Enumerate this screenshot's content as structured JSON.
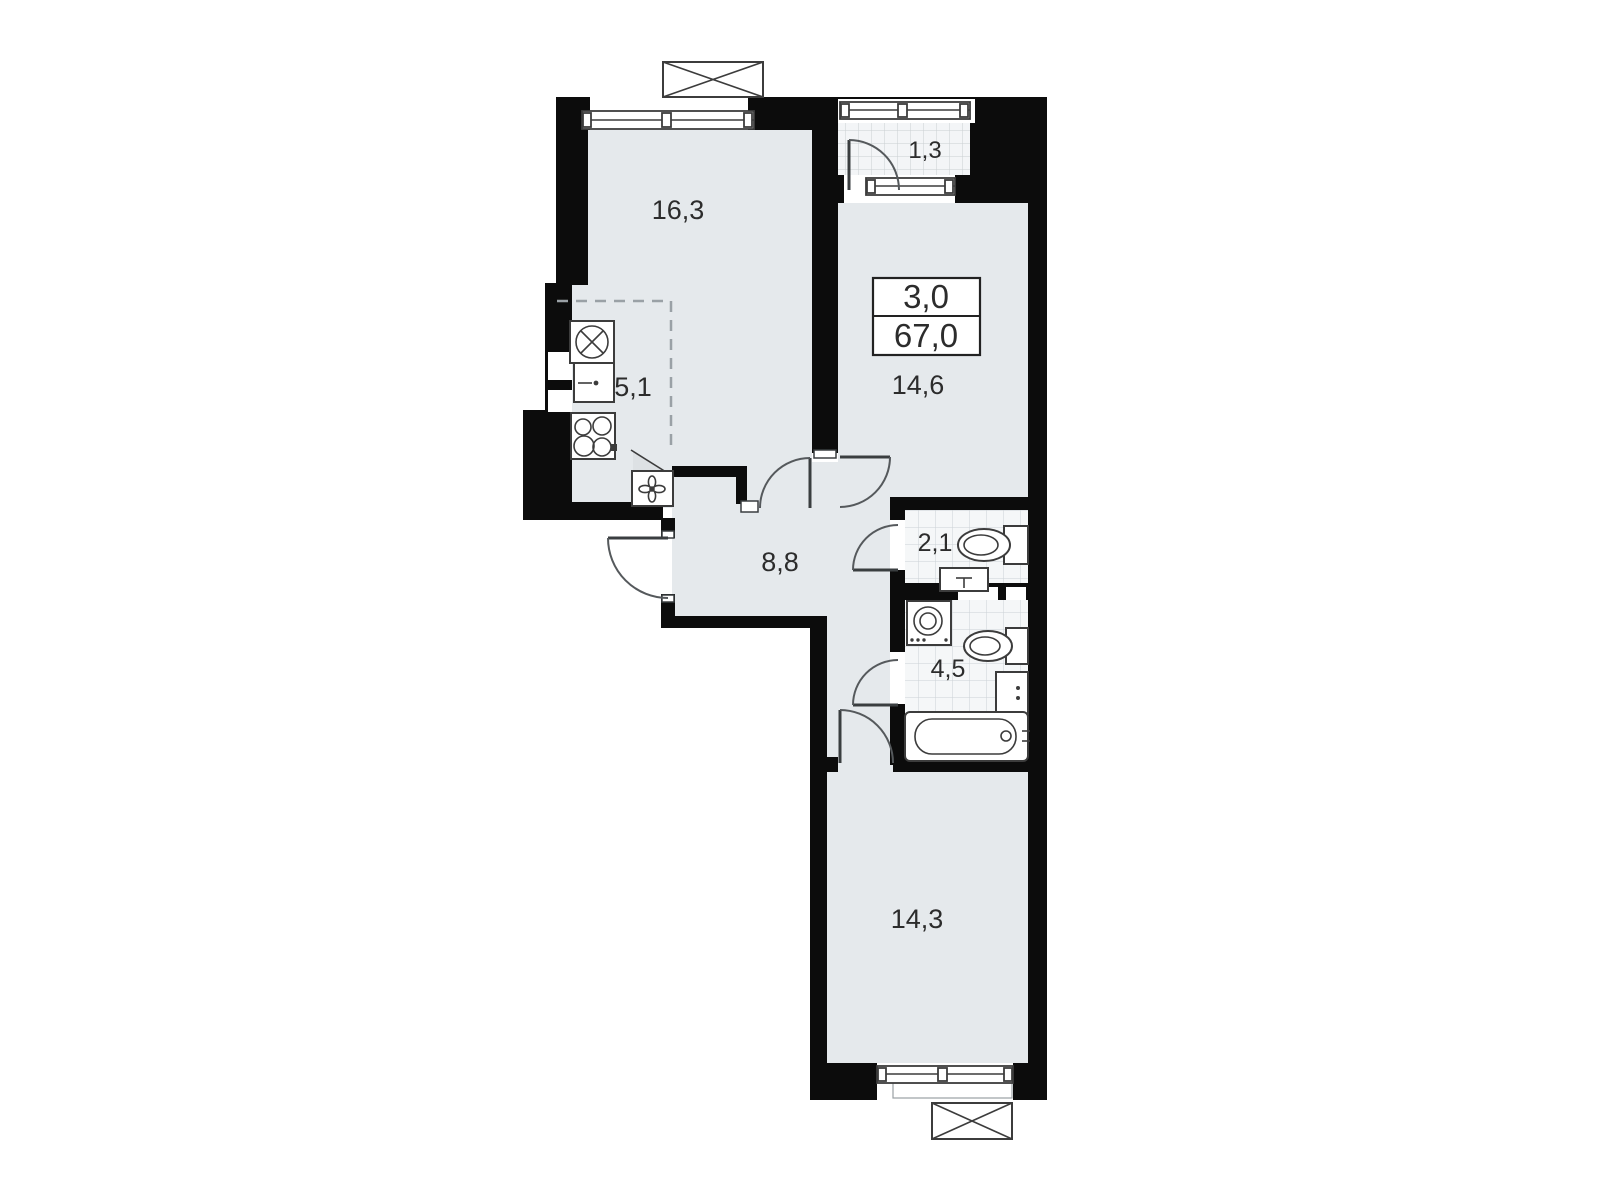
{
  "plan": {
    "title": "3-room apartment floor plan",
    "info_box": {
      "rooms_count": "3,0",
      "total_area": "67,0"
    },
    "rooms": [
      {
        "name": "living-room",
        "area": "16,3"
      },
      {
        "name": "kitchen",
        "area": "5,1"
      },
      {
        "name": "bedroom-1",
        "area": "14,6"
      },
      {
        "name": "balcony",
        "area": "1,3"
      },
      {
        "name": "hallway",
        "area": "8,8"
      },
      {
        "name": "wc",
        "area": "2,1"
      },
      {
        "name": "bathroom",
        "area": "4,5"
      },
      {
        "name": "bedroom-2",
        "area": "14,3"
      }
    ],
    "icons": [
      "kitchen-sink-icon",
      "refrigerator-icon",
      "stove-icon",
      "extractor-fan-icon",
      "toilet-icon",
      "wash-basin-icon",
      "washing-machine-icon",
      "bathtub-icon",
      "window-icon",
      "air-conditioner-icon",
      "door-swing-icon",
      "duct-shaft-icon"
    ],
    "colors": {
      "wall": "#0c0c0c",
      "floor": "#e5e9ec",
      "tile": "#f5f7f8",
      "tile_line": "#ccd2d6",
      "outline": "#3c3c3c",
      "text": "#2c2c2c",
      "dashed": "#9aa1a6",
      "bg": "#ffffff"
    }
  }
}
